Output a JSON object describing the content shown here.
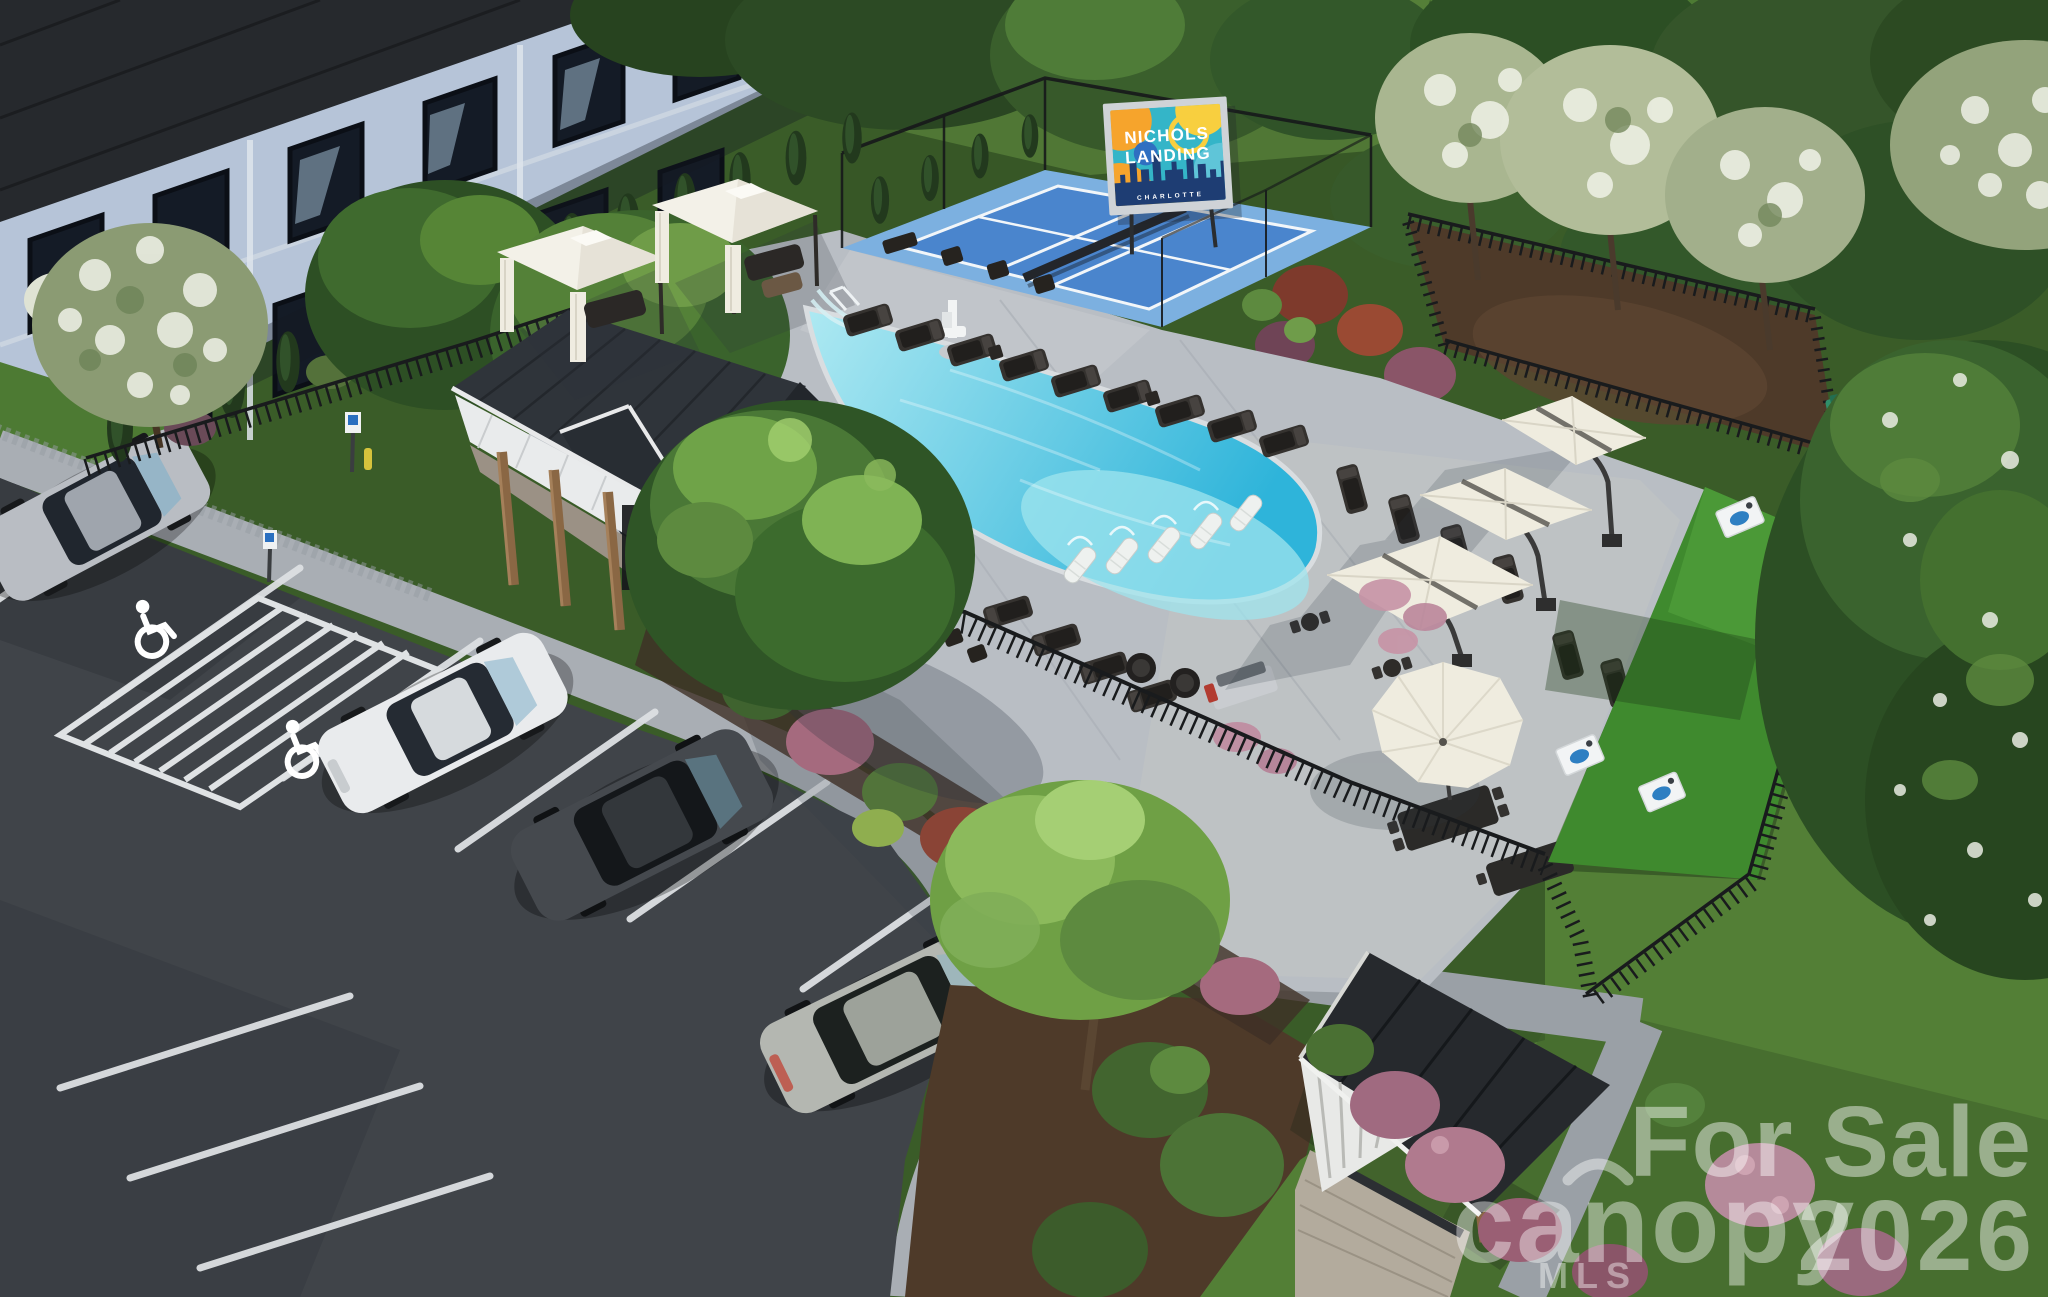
{
  "sign": {
    "line1": "NICHOLS",
    "line2": "LANDING",
    "city": "CHARLOTTE"
  },
  "watermarks": {
    "brand": "canopy",
    "brand_sub": "MLS",
    "sale_line1": "For Sale",
    "sale_line2": "2026"
  },
  "colors": {
    "asphalt": "#404449",
    "concrete_deck": "#b9bec4",
    "sidewalk": "#a9aeb4",
    "pool_shallow": "#aee9f2",
    "pool_deep": "#2eb4da",
    "court_outer": "#7cb0e0",
    "court_inner": "#4a85cd",
    "court_line": "#f2f6f9",
    "turf": "#3f8a2e",
    "grass": "#537f36",
    "grass_dark": "#3a5c28",
    "mulch": "#4e3a29",
    "fence": "#191b1d",
    "building_wall": "#b6c4d8",
    "building_roof": "#26292d",
    "clubhouse_roof": "#2f343a",
    "structure_white": "#eceeee",
    "wood": "#8a6744",
    "umbrella": "#efecdf",
    "cabana": "#f3f1e8",
    "sign_frame": "#cfd3d7",
    "sign_teal": "#34b5c8",
    "sign_orange": "#f6a42c",
    "sign_yellow": "#f8cf3f",
    "sign_blue": "#2f6fc1",
    "sign_navy": "#1e3d73",
    "cornhole_blue": "#2e7fc2",
    "pet_station_teal": "#2f8f6a",
    "watermark": "#ffffff"
  }
}
